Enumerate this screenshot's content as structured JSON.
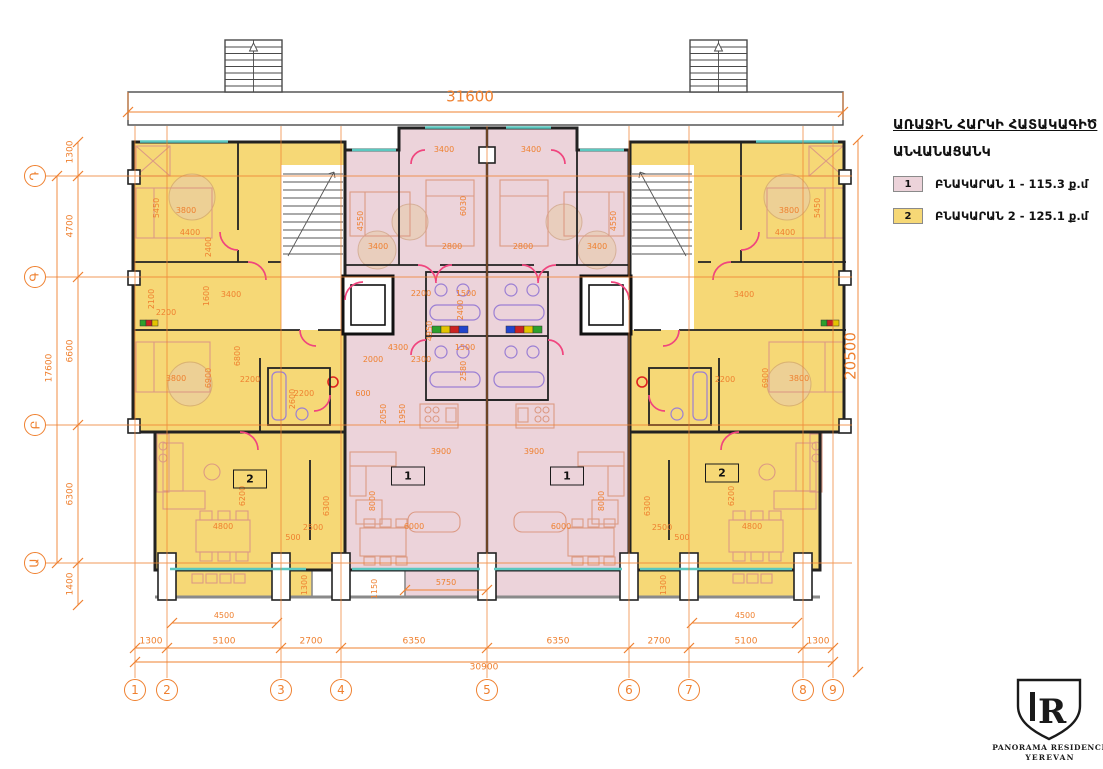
{
  "legend": {
    "title": "ԱՌԱՋԻՆ ՀԱՐԿԻ ՀԱՏԱԿԱԳԻԾ",
    "subtitle": "ԱՆՎԱՆԱՑԱՆԿ",
    "items": [
      {
        "key": "1",
        "label": "ԲՆԱԿԱՐԱՆ 1 - 115.3 ք.մ",
        "color": "#ecd3da"
      },
      {
        "key": "2",
        "label": "ԲՆԱԿԱՐԱՆ 2 - 125.1 ք.մ",
        "color": "#f6d876"
      }
    ]
  },
  "logo": {
    "monogram": "R",
    "line1": "PANORAMA RESIDENCE",
    "line2": "YEREVAN"
  },
  "grid": {
    "columns": [
      {
        "label": "1",
        "x": 135
      },
      {
        "label": "2",
        "x": 167
      },
      {
        "label": "3",
        "x": 281
      },
      {
        "label": "4",
        "x": 341
      },
      {
        "label": "5",
        "x": 487
      },
      {
        "label": "6",
        "x": 629
      },
      {
        "label": "7",
        "x": 689
      },
      {
        "label": "8",
        "x": 803
      },
      {
        "label": "9",
        "x": 833
      }
    ],
    "rows": [
      {
        "label": "Դ",
        "y": 176
      },
      {
        "label": "Գ",
        "y": 277
      },
      {
        "label": "Բ",
        "y": 425
      },
      {
        "label": "Ա",
        "y": 563
      }
    ]
  },
  "units": [
    {
      "label": "1",
      "x": 408,
      "y": 476
    },
    {
      "label": "1",
      "x": 567,
      "y": 476
    },
    {
      "label": "2",
      "x": 250,
      "y": 479
    },
    {
      "label": "2",
      "x": 722,
      "y": 473
    }
  ],
  "dims": [
    {
      "t": "31600",
      "x": 470,
      "y": 97,
      "r": 0,
      "s": 15
    },
    {
      "t": "20500",
      "x": 851,
      "y": 356,
      "r": -90,
      "s": 15
    },
    {
      "t": "1300",
      "x": 151,
      "y": 642,
      "s": 9
    },
    {
      "t": "5100",
      "x": 224,
      "y": 642,
      "s": 9
    },
    {
      "t": "2700",
      "x": 311,
      "y": 642,
      "s": 9
    },
    {
      "t": "6350",
      "x": 414,
      "y": 642,
      "s": 9
    },
    {
      "t": "6350",
      "x": 558,
      "y": 642,
      "s": 9
    },
    {
      "t": "2700",
      "x": 659,
      "y": 642,
      "s": 9
    },
    {
      "t": "5100",
      "x": 746,
      "y": 642,
      "s": 9
    },
    {
      "t": "1300",
      "x": 818,
      "y": 642,
      "s": 9
    },
    {
      "t": "30900",
      "x": 484,
      "y": 668,
      "s": 9
    },
    {
      "t": "1300",
      "x": 71,
      "y": 152,
      "r": -90,
      "s": 9
    },
    {
      "t": "4700",
      "x": 71,
      "y": 226,
      "r": -90,
      "s": 9
    },
    {
      "t": "6600",
      "x": 71,
      "y": 351,
      "r": -90,
      "s": 9
    },
    {
      "t": "6300",
      "x": 71,
      "y": 494,
      "r": -90,
      "s": 9
    },
    {
      "t": "1400",
      "x": 71,
      "y": 584,
      "r": -90,
      "s": 9
    },
    {
      "t": "17600",
      "x": 50,
      "y": 368,
      "r": -90,
      "s": 9
    },
    {
      "t": "4500",
      "x": 224,
      "y": 616
    },
    {
      "t": "4500",
      "x": 745,
      "y": 616
    },
    {
      "t": "1300",
      "x": 305,
      "y": 585,
      "r": -90
    },
    {
      "t": "1300",
      "x": 664,
      "y": 585,
      "r": -90
    },
    {
      "t": "5750",
      "x": 446,
      "y": 583
    },
    {
      "t": "1150",
      "x": 375,
      "y": 589,
      "r": -90
    },
    {
      "t": "5450",
      "x": 157,
      "y": 208,
      "r": -90
    },
    {
      "t": "3800",
      "x": 186,
      "y": 211
    },
    {
      "t": "4400",
      "x": 190,
      "y": 233
    },
    {
      "t": "2400",
      "x": 209,
      "y": 247,
      "r": -90
    },
    {
      "t": "2100",
      "x": 152,
      "y": 299,
      "r": -90
    },
    {
      "t": "2200",
      "x": 166,
      "y": 313
    },
    {
      "t": "1600",
      "x": 207,
      "y": 296,
      "r": -90
    },
    {
      "t": "3400",
      "x": 231,
      "y": 295
    },
    {
      "t": "3800",
      "x": 176,
      "y": 379
    },
    {
      "t": "6900",
      "x": 209,
      "y": 378,
      "r": -90
    },
    {
      "t": "6800",
      "x": 238,
      "y": 356,
      "r": -90
    },
    {
      "t": "2200",
      "x": 250,
      "y": 380
    },
    {
      "t": "2600",
      "x": 293,
      "y": 399,
      "r": -90
    },
    {
      "t": "2200",
      "x": 304,
      "y": 394
    },
    {
      "t": "6200",
      "x": 243,
      "y": 496,
      "r": -90
    },
    {
      "t": "4800",
      "x": 223,
      "y": 527
    },
    {
      "t": "500",
      "x": 293,
      "y": 538
    },
    {
      "t": "2500",
      "x": 313,
      "y": 528
    },
    {
      "t": "6300",
      "x": 327,
      "y": 506,
      "r": -90
    },
    {
      "t": "3400",
      "x": 444,
      "y": 150
    },
    {
      "t": "4550",
      "x": 361,
      "y": 221,
      "r": -90
    },
    {
      "t": "3400",
      "x": 378,
      "y": 247
    },
    {
      "t": "6030",
      "x": 464,
      "y": 206,
      "r": -90
    },
    {
      "t": "2800",
      "x": 452,
      "y": 247
    },
    {
      "t": "2200",
      "x": 421,
      "y": 294
    },
    {
      "t": "1500",
      "x": 466,
      "y": 294
    },
    {
      "t": "2400",
      "x": 461,
      "y": 310,
      "r": -90
    },
    {
      "t": "4950",
      "x": 430,
      "y": 331,
      "r": -90
    },
    {
      "t": "4300",
      "x": 398,
      "y": 348
    },
    {
      "t": "2000",
      "x": 373,
      "y": 360
    },
    {
      "t": "2300",
      "x": 421,
      "y": 360
    },
    {
      "t": "1500",
      "x": 465,
      "y": 348
    },
    {
      "t": "2580",
      "x": 464,
      "y": 371,
      "r": -90
    },
    {
      "t": "600",
      "x": 363,
      "y": 394
    },
    {
      "t": "2050",
      "x": 384,
      "y": 414,
      "r": -90
    },
    {
      "t": "1950",
      "x": 403,
      "y": 414,
      "r": -90
    },
    {
      "t": "3900",
      "x": 441,
      "y": 452
    },
    {
      "t": "8000",
      "x": 373,
      "y": 501,
      "r": -90
    },
    {
      "t": "6000",
      "x": 414,
      "y": 527
    },
    {
      "t": "3400",
      "x": 531,
      "y": 150
    },
    {
      "t": "4550",
      "x": 614,
      "y": 221,
      "r": -90
    },
    {
      "t": "2800",
      "x": 523,
      "y": 247
    },
    {
      "t": "3400",
      "x": 597,
      "y": 247
    },
    {
      "t": "3900",
      "x": 534,
      "y": 452
    },
    {
      "t": "6000",
      "x": 561,
      "y": 527
    },
    {
      "t": "8000",
      "x": 602,
      "y": 501,
      "r": -90
    },
    {
      "t": "5450",
      "x": 818,
      "y": 208,
      "r": -90
    },
    {
      "t": "3800",
      "x": 789,
      "y": 211
    },
    {
      "t": "4400",
      "x": 785,
      "y": 233
    },
    {
      "t": "3800",
      "x": 799,
      "y": 379
    },
    {
      "t": "6900",
      "x": 766,
      "y": 378,
      "r": -90
    },
    {
      "t": "2200",
      "x": 725,
      "y": 380
    },
    {
      "t": "3400",
      "x": 744,
      "y": 295
    },
    {
      "t": "6200",
      "x": 732,
      "y": 496,
      "r": -90
    },
    {
      "t": "4800",
      "x": 752,
      "y": 527
    },
    {
      "t": "2500",
      "x": 662,
      "y": 528
    },
    {
      "t": "500",
      "x": 682,
      "y": 538
    },
    {
      "t": "6300",
      "x": 648,
      "y": 506,
      "r": -90
    }
  ],
  "colors": {
    "apartment1": "#ecd3da",
    "apartment2": "#f6d876",
    "grid": "#ef802f",
    "wall": "#222222",
    "window": "#5bc8c0",
    "door": "#f0457e",
    "furniture": "#dc9a84",
    "fixtures": "#9b7fd4"
  }
}
